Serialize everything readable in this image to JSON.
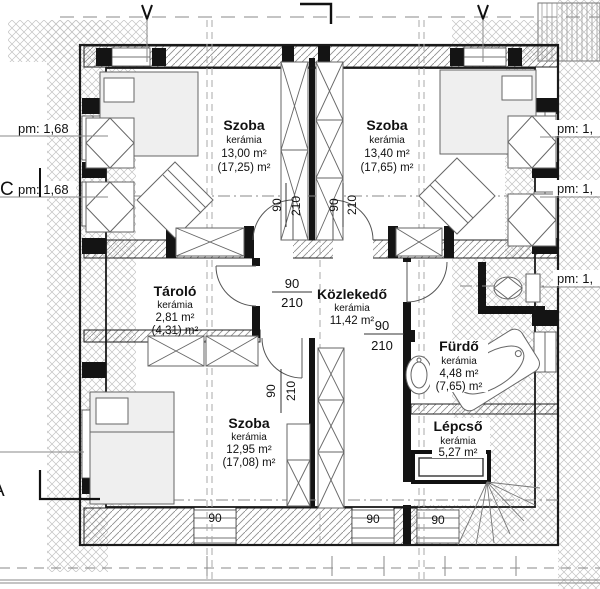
{
  "plan": {
    "rooms": {
      "szoba_nw": {
        "name": "Szoba",
        "finish": "kerámia",
        "area": "13,00 m²",
        "total": "(17,25) m²"
      },
      "szoba_ne": {
        "name": "Szoba",
        "finish": "kerámia",
        "area": "13,40 m²",
        "total": "(17,65) m²"
      },
      "tarolo": {
        "name": "Tároló",
        "finish": "kerámia",
        "area": "2,81 m²",
        "total": "(4,31) m²"
      },
      "kozlekedo": {
        "name": "Közlekedő",
        "finish": "kerámia",
        "area": "11,42 m²"
      },
      "furdo": {
        "name": "Fürdő",
        "finish": "kerámia",
        "area": "4,48 m²",
        "total": "(7,65) m²"
      },
      "lepcso": {
        "name": "Lépcső",
        "finish": "kerámia",
        "area": "5,27 m²"
      },
      "szoba_s": {
        "name": "Szoba",
        "finish": "kerámia",
        "area": "12,95 m²",
        "total": "(17,08) m²"
      }
    },
    "dims": {
      "door_w": "90",
      "door_h": "210",
      "window_w": "90"
    },
    "levels": {
      "pm_left": "pm: 1,68",
      "pm_right_clipped": "pm: 1,"
    },
    "sections": {
      "c": "C",
      "a": "A"
    },
    "colors": {
      "line": "#1a1a1a",
      "wall_hatch": "#8f8f8f",
      "cross_hatch": "#c2c2c2",
      "furniture": "#666666"
    }
  }
}
